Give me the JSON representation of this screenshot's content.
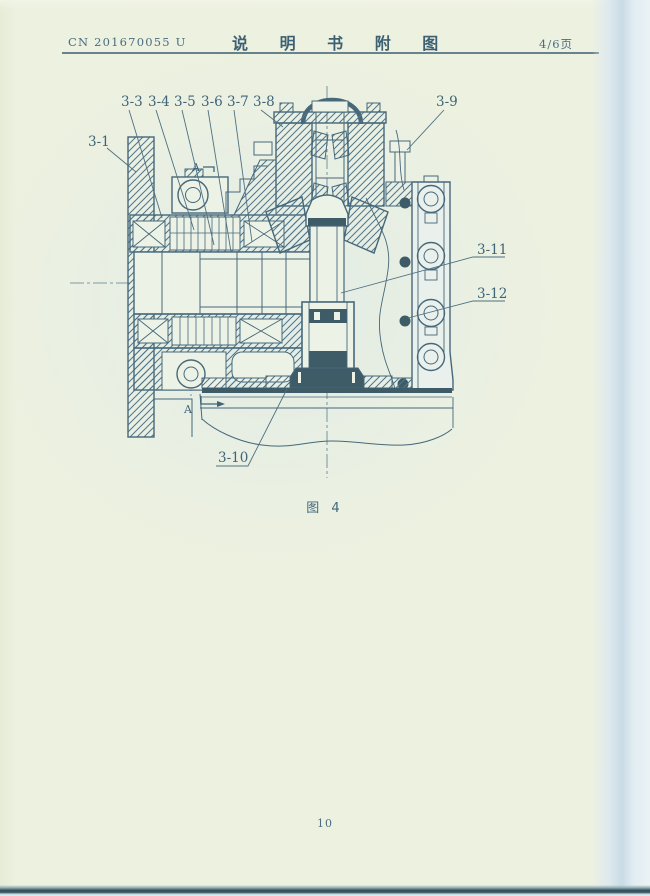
{
  "page": {
    "paper_color": "#edf1e0",
    "line_color": "#46687a",
    "dark_fill": "#3e5c68",
    "text_color": "#3f6478"
  },
  "header": {
    "patent_number": "CN 201670055 U",
    "title": "说 明 书 附 图",
    "page_indicator": "4/6页"
  },
  "figure": {
    "caption": "图 4",
    "section_marker_top": "A",
    "section_marker_bottom": "A",
    "part_labels": {
      "l3_1": "3-1",
      "l3_3": "3-3",
      "l3_4": "3-4",
      "l3_5": "3-5",
      "l3_6": "3-6",
      "l3_7": "3-7",
      "l3_8": "3-8",
      "l3_9": "3-9",
      "l3_10": "3-10",
      "l3_11": "3-11",
      "l3_12": "3-12"
    }
  },
  "footer": {
    "page_number": "10"
  }
}
